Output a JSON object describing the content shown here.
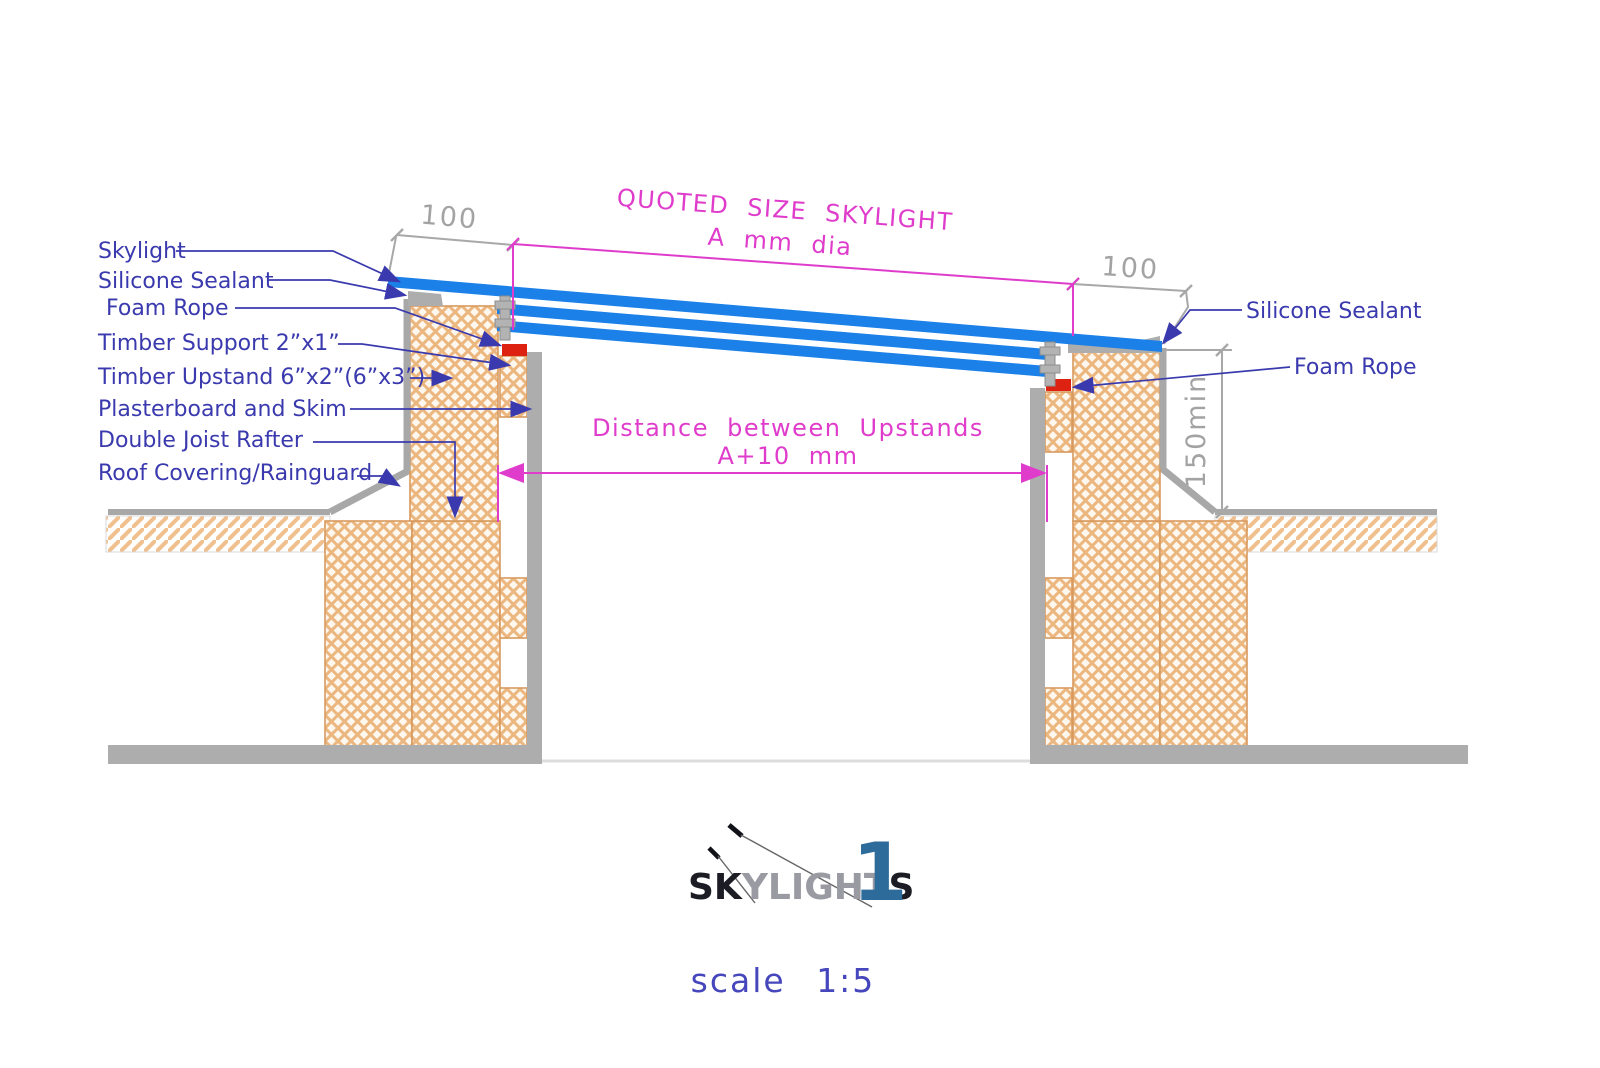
{
  "drawing": {
    "left_labels": [
      "Skylight",
      "Silicone Sealant",
      "Foam Rope",
      "Timber Support 2”x1”",
      "Timber Upstand 6”x2”(6”x3”)",
      "Plasterboard and Skim",
      "Double Joist Rafter",
      "Roof Covering/Rainguard"
    ],
    "right_labels": [
      "Silicone Sealant",
      "Foam Rope"
    ],
    "dims": {
      "overhang_left": "100",
      "overhang_right": "100",
      "upstand_min_height": "150min",
      "quoted_size_title": "QUOTED SIZE SKYLIGHT",
      "quoted_size_value": "A mm dia",
      "distance_title": "Distance between Upstands",
      "distance_value": "A+10 mm"
    }
  },
  "logo": {
    "sk": "SK",
    "ylight": "YLIGHT",
    "s": "S",
    "one": "1"
  },
  "footer": {
    "scale": "scale 1:5"
  },
  "colors": {
    "glass_blue": "#1b80e8",
    "label_blue": "#3a3aae",
    "dimension_magenta": "#e03ccc",
    "timber_hatch_orange": "#ecb67f",
    "foam_rope_red": "#dd2211",
    "plasterboard_gray": "#adadad",
    "dimension_gray": "#a3a3a3",
    "logo_blue": "#2d6b9a"
  }
}
